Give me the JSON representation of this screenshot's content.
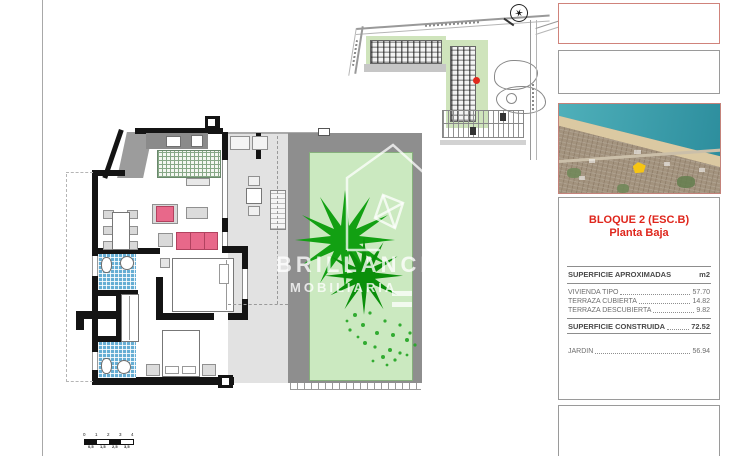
{
  "info_panel": {
    "title_line1": "BLOQUE 2 (ESC.B)",
    "title_line2": "Planta Baja",
    "table": {
      "header_label": "SUPERFICIE APROXIMADAS",
      "header_unit": "m2",
      "rows": [
        {
          "label": "VIVIENDA TIPO",
          "value": "57.70"
        },
        {
          "label": "TERRAZA CUBIERTA",
          "value": "14.82"
        },
        {
          "label": "TERRAZA DESCUBIERTA",
          "value": "9.82"
        }
      ],
      "total_label": "SUPERFICIE CONSTRUIDA",
      "total_value": "72.52",
      "garden_label": "JARDIN",
      "garden_value": "56.94"
    }
  },
  "watermark": {
    "line1": "BRILLANCE",
    "line2": "MOBILIARIA"
  },
  "scale_bar": {
    "top_labels": [
      "0",
      "1",
      "2",
      "3",
      "4"
    ],
    "bottom_labels": [
      "0,5",
      "1,5",
      "2,5",
      "3,5"
    ]
  },
  "colors": {
    "accent_red": "#df261c",
    "photo_border": "#c4827a",
    "garden_green": "#cbe9c0",
    "plant_green": "#12a012",
    "bathroom_blue": "#66aed4",
    "furniture_pink": "#e8688a",
    "wall_black": "#141414",
    "terrace_gray": "#e2e2e2",
    "garden_frame_gray": "#8e8e8e"
  }
}
